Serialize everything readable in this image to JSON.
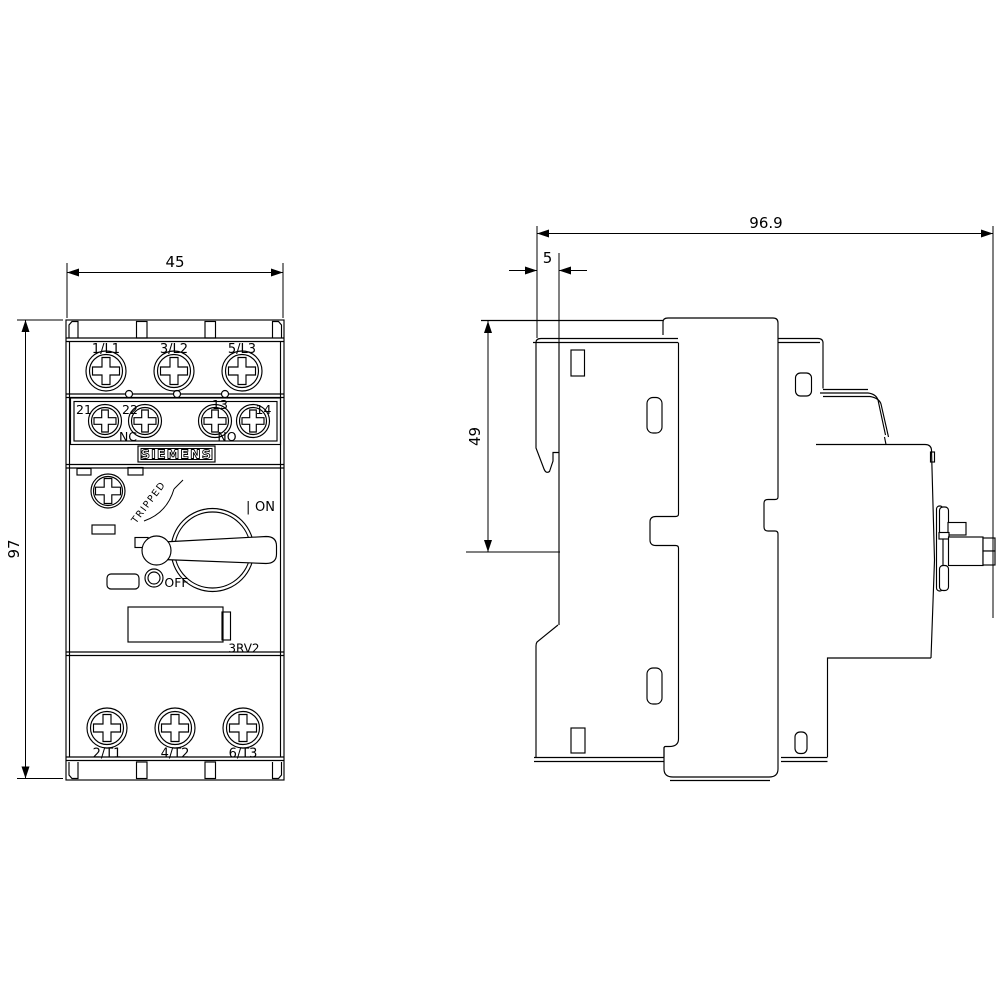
{
  "front_view": {
    "width_dim": "45",
    "height_dim": "97",
    "brand_label": "SIEMENS",
    "product_code": "3RV2",
    "line_terminal_labels": [
      "1/L1",
      "3/L2",
      "5/L3"
    ],
    "aux_terminal_labels": [
      "21",
      "22",
      "13",
      "14"
    ],
    "aux_nc_label": "NC",
    "aux_no_label": "NO",
    "load_terminal_labels": [
      "2/T1",
      "4/T2",
      "6/T3"
    ],
    "tripped_label": "TRIPPED",
    "on_marker": "|",
    "on_label": "ON",
    "off_label": "OFF"
  },
  "side_view": {
    "depth_dim": "96.9",
    "rail_clip_dim": "5",
    "upper_depth_dim": "49"
  }
}
